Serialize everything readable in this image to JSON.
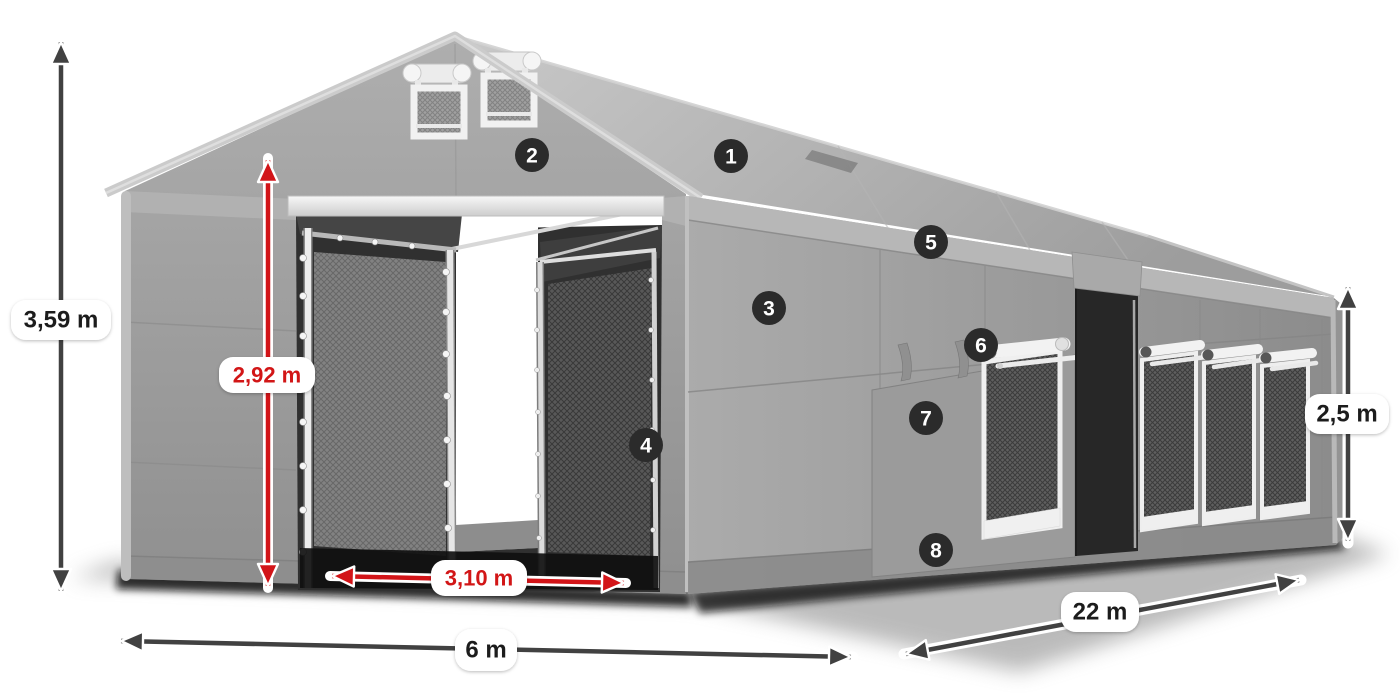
{
  "dimensions": {
    "total_height": "3,59 m",
    "gate_height": "2,92 m",
    "gate_width": "3,10 m",
    "front_width": "6 m",
    "side_length": "22 m",
    "wall_height": "2,5 m"
  },
  "callouts": [
    "1",
    "2",
    "3",
    "4",
    "5",
    "6",
    "7",
    "8"
  ],
  "colors": {
    "dimension_red": "#d21418",
    "dimension_dark": "#414141",
    "badge_background": "#2b2b2b",
    "badge_number": "#ffffff",
    "pill_background": "#ffffff",
    "pill_text_dark": "#1c1c1c"
  }
}
